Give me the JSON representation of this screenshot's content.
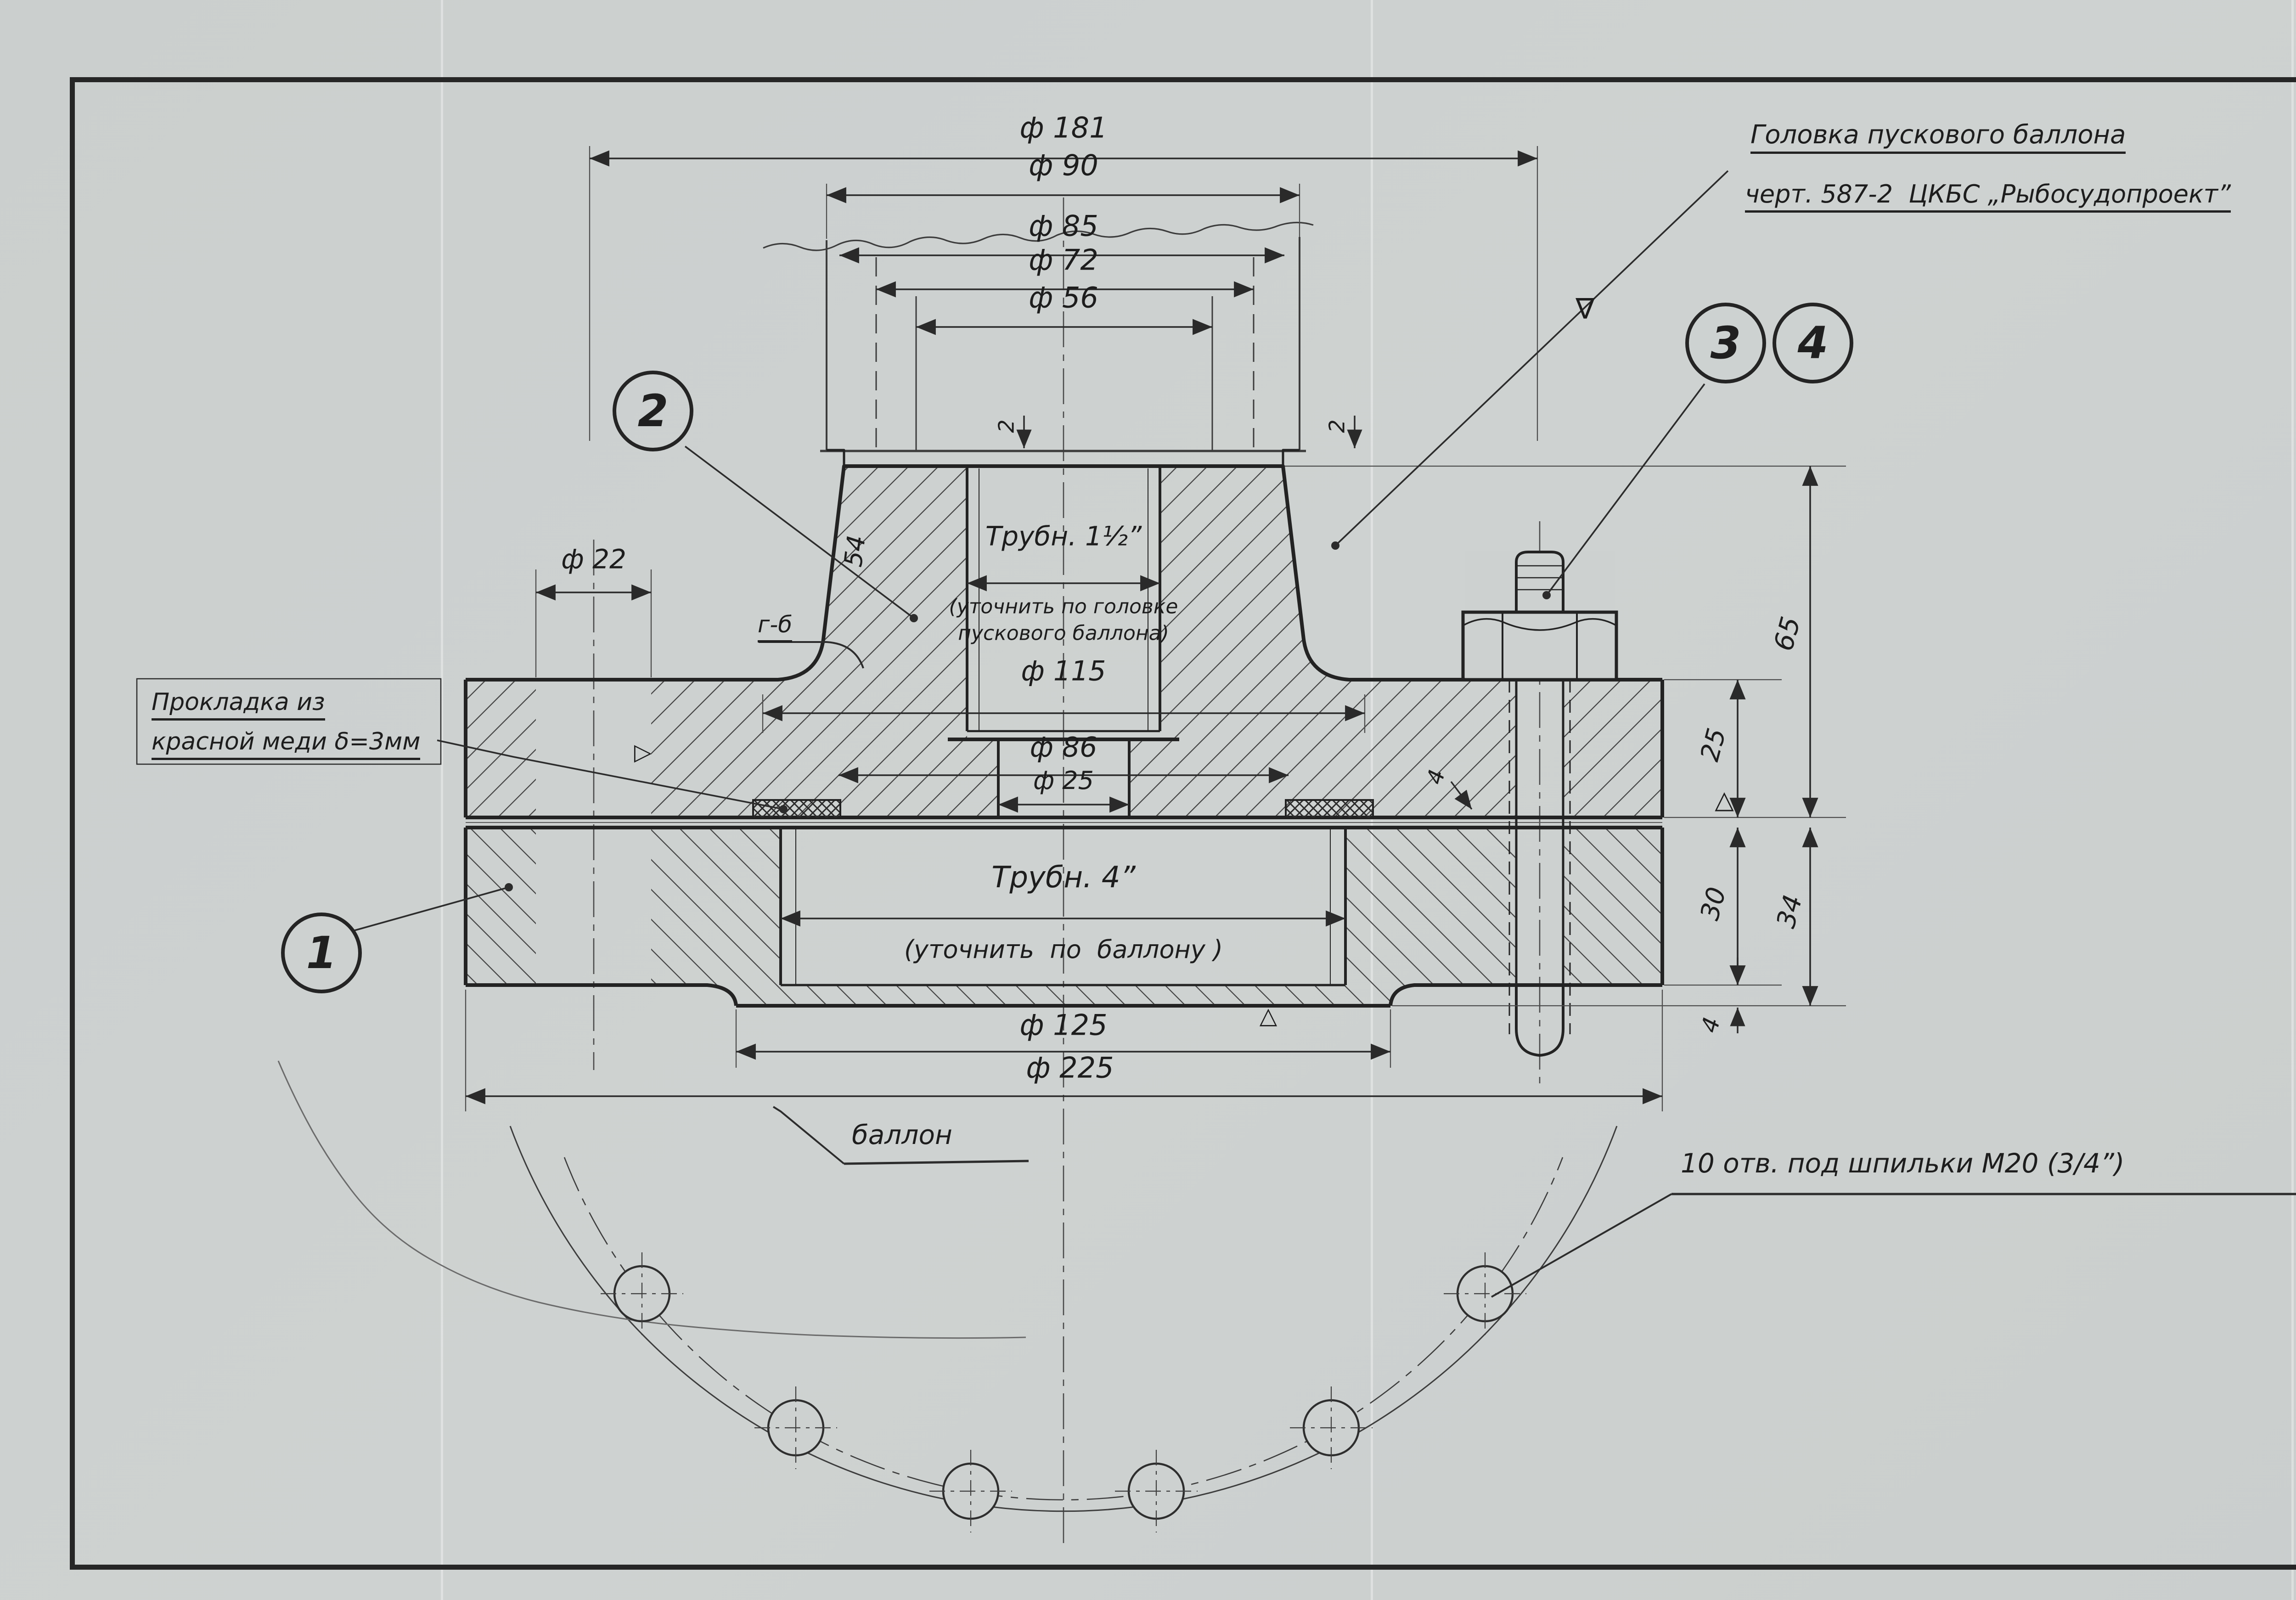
{
  "sheet": {
    "number": "1897",
    "logo_text": "АСВ",
    "org": "МРП-СССР\nГЛАВРЫБОСУДОСТРОЙ\nАРХАНГЕЛЬСКАЯ\nВЕРФЬ"
  },
  "callouts": {
    "c1": "1",
    "c2": "2",
    "c3": "3",
    "c4": "4"
  },
  "symbols": {
    "finish": "∇",
    "datum_a": "△",
    "datum_b": "△",
    "flag": "▷"
  },
  "notes": {
    "head1": "Головка пускового баллона",
    "head2": "черт. 587-2  ЦКБС „Рыбосудопроект”",
    "gasket1": "Прокладка из",
    "gasket2": "красной меди δ=3мм",
    "balloon": "баллон",
    "holes": "10 отв. под шпильки М20 (3/4”)",
    "remark_title": "Примечание:",
    "remark1": "1. Размеры фланцев выполнены в соответствии",
    "remark2": "с  гостом  1536-42",
    "section": "г-б"
  },
  "dims": {
    "d181": "ф 181",
    "d90": "ф 90",
    "d85": "ф 85",
    "d72": "ф 72",
    "d56": "ф 56",
    "d22": "ф 22",
    "d115": "ф 115",
    "d86": "ф 86",
    "d25": "ф 25",
    "d125": "ф 125",
    "d225": "ф 225",
    "v65": "65",
    "v25": "25",
    "v30": "30",
    "v34": "34",
    "v4": "4",
    "v4b": "4",
    "s2a": "2",
    "s2b": "2",
    "slant": "54"
  },
  "pipe": {
    "p1": "Трубн. 1½”",
    "p1n1": "(уточнить по головке",
    "p1n2": "пускового баллона)",
    "p4": "Трубн. 4”",
    "p4n": "(уточнить  по  баллону )"
  },
  "parts_table": {
    "headers": {
      "num": "№\nном.",
      "det": "№\nдет.",
      "name": "Наименование",
      "qty": "К-во",
      "mat": "М-Л",
      "w_st": "шт.",
      "w_ob": "Общ.",
      "w_bot": "Вес кг.",
      "size": "Размер\nост",
      "note": "Примеч."
    },
    "rows": [
      {
        "det": "4",
        "name": "Шпилька М20×75",
        "qty": "10",
        "mat": "Ст.4",
        "w1": "0,023",
        "w2": "0,23",
        "size": "ост\n20001-38"
      },
      {
        "det": "3",
        "name": "Гайка  М20 (3/4”)",
        "qty": "10",
        "mat": "Ст.3",
        "w1": "0,0076",
        "w2": "0,076",
        "size": "ост-НКТп\n3311"
      },
      {
        "det": "2",
        "name": "Фланец к головки",
        "qty": "1",
        "mat": "Ст.3",
        "w1": "6,58",
        "w2": "6,58",
        "size": ""
      },
      {
        "det": "1",
        "name": "фланец к баллону",
        "qty": "1",
        "mat": "Ст.3",
        "w1": "5,10",
        "w2": "5,10",
        "size": ""
      }
    ]
  },
  "title_block": {
    "project": "Зверобойная\nшхуна № 2",
    "title": "Установка головки\nна баллон сжатого\nвоздуха д/тифона.",
    "nomen": "Номенклатурн.\n№\nизделия",
    "order": "Заказ",
    "scale": "Масштаб\n1:1",
    "date": "Дата\n10-XI-52г.",
    "sign_rows": [
      {
        "label": "Капировал.",
        "name": "Нянникова"
      },
      {
        "label": "Конструк.",
        "name": ""
      },
      {
        "label": "Н-к К.Б.",
        "name": "Знаменская"
      },
      {
        "label": "Н-к Т.О.",
        "name": "Кычин"
      }
    ]
  }
}
